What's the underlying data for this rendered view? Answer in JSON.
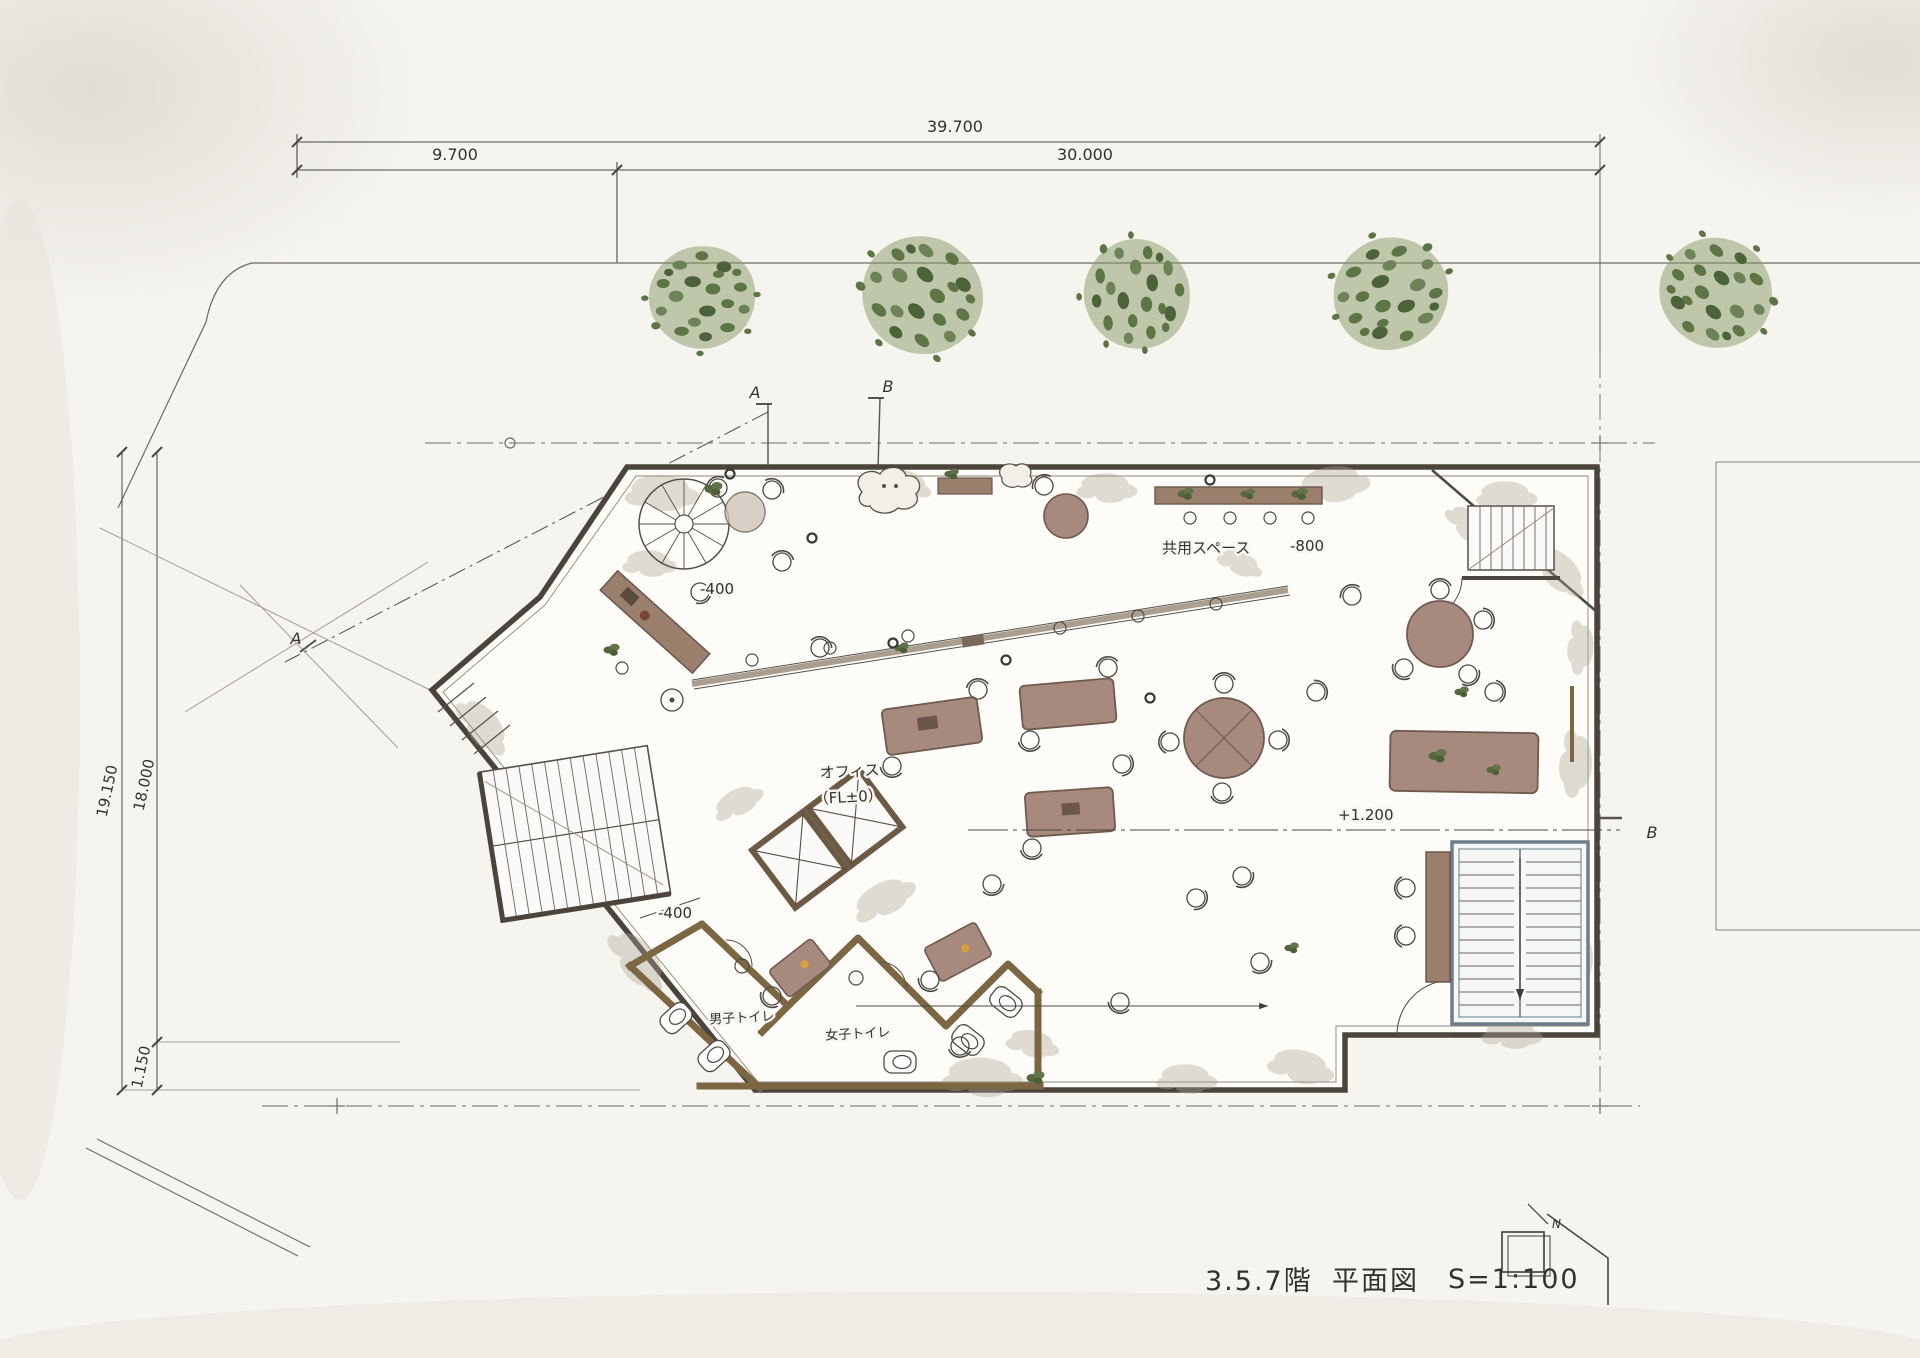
{
  "dimensions": {
    "top_total": "39.700",
    "top_left": "9.700",
    "top_right": "30.000",
    "left_outer": "19.150",
    "left_inner": "18.000",
    "left_bottom": "1.150"
  },
  "levels": {
    "office_name": "オフィス",
    "office_level": "（FL±0）",
    "common_name": "共用スペース",
    "common_level": "-800",
    "upper_entry": "-400",
    "lower_entry": "-400",
    "terrace": "+1.200"
  },
  "rooms": {
    "mens_toilet": "男子トイレ",
    "womens_toilet": "女子トイレ"
  },
  "sections": {
    "a": "A",
    "b": "B"
  },
  "title_block": {
    "floors": "3.5.7階",
    "drawing": "平面図",
    "scale": "S=1:100",
    "north": "N"
  },
  "colors": {
    "wall_ink": "#4a443d",
    "wood_wall": "#7d6743",
    "furniture": "#a8897e",
    "tree_green": "#5d7444",
    "stair_steel": "#6f7d88",
    "paper": "#f6f4ef"
  }
}
